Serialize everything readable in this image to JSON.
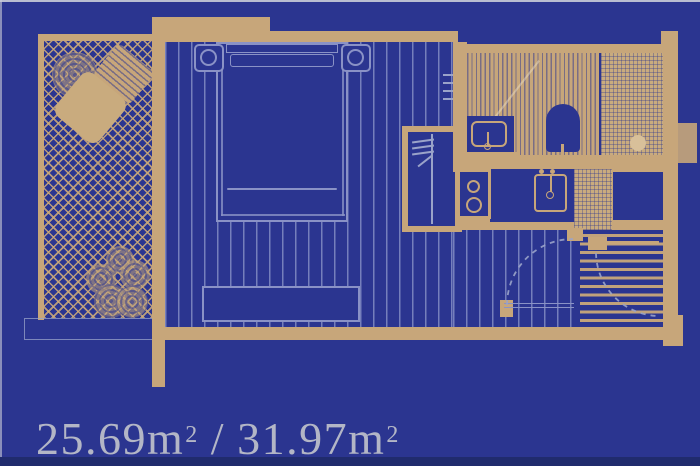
{
  "area_label": {
    "net_value": "25.69",
    "gross_value": "31.97",
    "unit": "m",
    "unit_exponent": "2",
    "separator": "/",
    "full_text": "25.69m2 / 31.97m2"
  },
  "colors": {
    "background": "#2b3590",
    "wall": "#c7a67a",
    "furniture_outline": "#8a92c6",
    "door_swing": "#9aa3c9",
    "label_text": "#b3b6c6",
    "bottom_band": "#202b6d"
  },
  "floor_plan": {
    "type": "studio-apartment",
    "rooms": [
      {
        "name": "balcony",
        "floor": "diagonal-crosshatch",
        "fixtures": [
          "potted-plant",
          "lounge-chair",
          "potted-plant"
        ]
      },
      {
        "name": "bedroom-living",
        "floor": "vertical-plank-stripes",
        "fixtures": [
          "double-bed",
          "nightstand-lamp-left",
          "nightstand-lamp-right",
          "bench",
          "wardrobe"
        ]
      },
      {
        "name": "bathroom",
        "floor": "fine-tile-stripes",
        "fixtures": [
          "washbasin",
          "toilet",
          "shower-with-drain"
        ]
      },
      {
        "name": "kitchen",
        "fixtures": [
          "cooktop-two-burners",
          "kitchen-sink",
          "refrigerator"
        ]
      },
      {
        "name": "entry-hall",
        "floor": "horizontal-stripes",
        "fixtures": [
          "entrance-door-swing",
          "interior-door-swing"
        ]
      }
    ]
  }
}
